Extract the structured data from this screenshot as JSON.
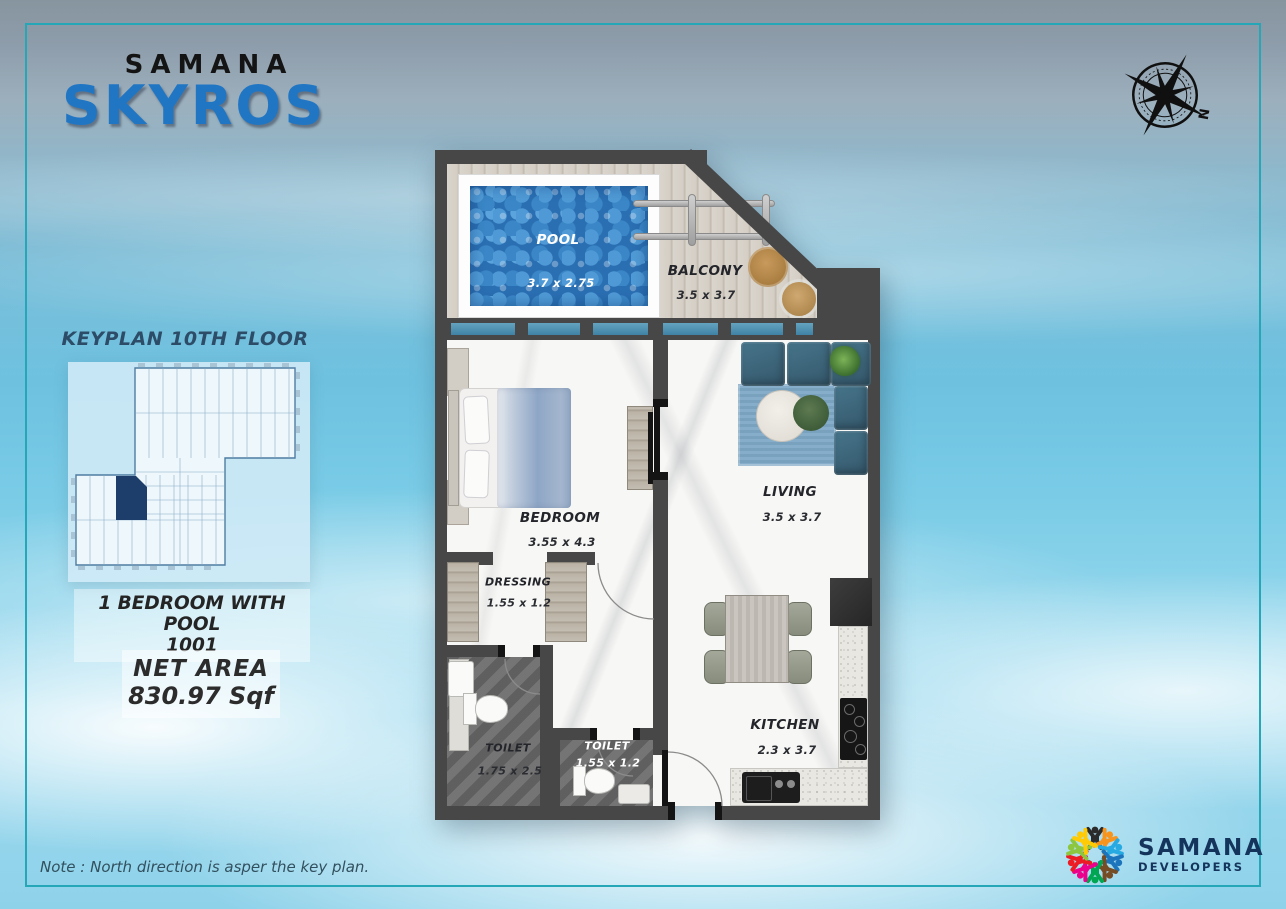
{
  "brand": {
    "parent": "SAMANA",
    "project": "SKYROS"
  },
  "compass": {
    "north": "N"
  },
  "keyplan": {
    "title": "KEYPLAN 10TH FLOOR"
  },
  "unit": {
    "type": "1 BEDROOM WITH POOL",
    "number": "1001",
    "net_area_label": "NET AREA",
    "net_area_value": "830.97 Sqf"
  },
  "rooms": {
    "pool": {
      "name": "POOL",
      "dims": "3.7  x 2.75"
    },
    "balcony": {
      "name": "BALCONY",
      "dims": "3.5  x 3.7"
    },
    "bedroom": {
      "name": "BEDROOM",
      "dims": "3.55  x 4.3"
    },
    "living": {
      "name": "LIVING",
      "dims": "3.5  x 3.7"
    },
    "dressing": {
      "name": "DRESSING",
      "dims": "1.55 x 1.2"
    },
    "toilet_master": {
      "name": "TOILET",
      "dims": "1.75 x 2.5"
    },
    "toilet_guest": {
      "name": "TOILET",
      "dims": "1.55 x 1.2"
    },
    "kitchen": {
      "name": "KITCHEN",
      "dims": "2.3  x 3.7"
    }
  },
  "note": "Note : North direction is asper the key plan.",
  "developer": {
    "name": "SAMANA",
    "subtitle": "DEVELOPERS"
  },
  "colors": {
    "frame_teal": "#25a7b7",
    "project_blue": "#2176c4",
    "developer_navy": "#14345c",
    "wall_gray": "#474747",
    "pool_water_blue": "#2a6fb2",
    "keyplan_highlight_navy": "#1d3e6a",
    "sofa_blue": "#3b6579",
    "rug_blue": "#7ea8c6"
  }
}
